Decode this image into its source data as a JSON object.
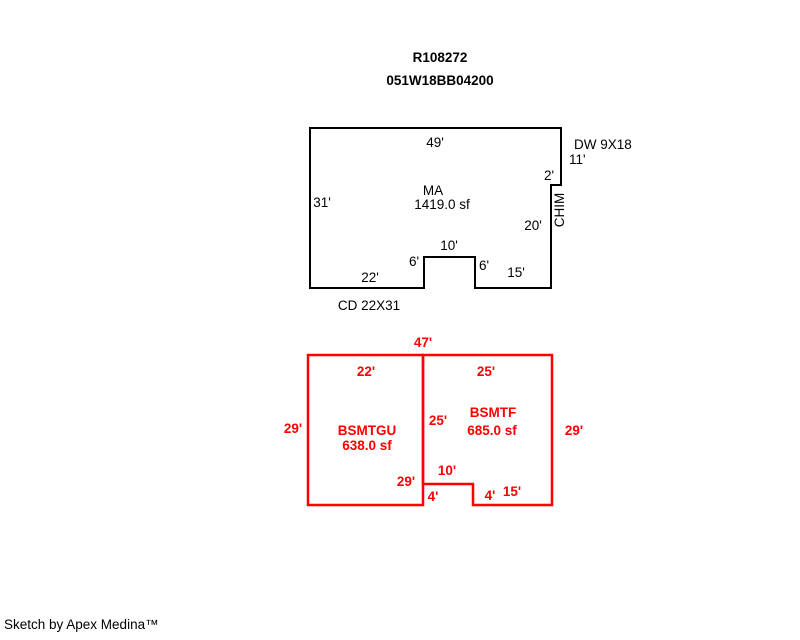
{
  "header": {
    "record_id": "R108272",
    "parcel_number": "051W18BB04200"
  },
  "colors": {
    "background": "#ffffff",
    "main_floor_outline": "#000000",
    "basement_outline": "#ff0000"
  },
  "main_floor": {
    "label": "MA",
    "area": "1419.0 sf",
    "dim_top": "49'",
    "dim_left": "31'",
    "dim_bottom_left": "22'",
    "dim_notch_left": "6'",
    "dim_notch_top": "10'",
    "dim_notch_right": "6'",
    "dim_bottom_right": "15'",
    "dim_right_lower": "20'",
    "dim_right_step": "2'",
    "dim_right_upper": "11'",
    "deck_label": "DW 9X18",
    "chimney_label": "CHIM",
    "carport_label": "CD 22X31"
  },
  "basement": {
    "dim_total_width": "47'",
    "left_unit": {
      "label": "BSMTGU",
      "area": "638.0 sf",
      "dim_top": "22'",
      "dim_left": "29'",
      "dim_divider_full": "29'"
    },
    "right_unit": {
      "label": "BSMTF",
      "area": "685.0 sf",
      "dim_top": "25'",
      "dim_left": "25'",
      "dim_right": "29'",
      "dim_notch_top": "10'",
      "dim_notch_left": "4'",
      "dim_notch_right": "4'",
      "dim_bottom": "15'"
    }
  },
  "footer": {
    "credit": "Sketch by Apex Medina™"
  }
}
